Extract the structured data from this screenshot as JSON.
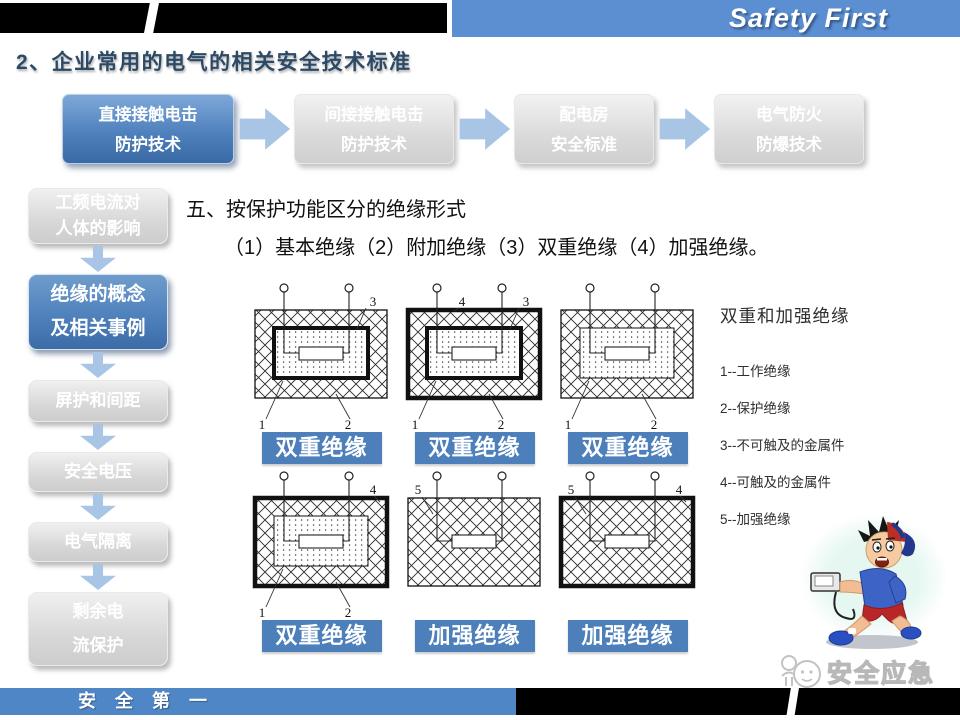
{
  "header": {
    "brand": "Safety First",
    "title": "2、企业常用的电气的相关安全技术标准"
  },
  "process_flow": [
    {
      "line1": "直接接触电击",
      "line2": "防护技术",
      "active": true
    },
    {
      "line1": "间接接触电击",
      "line2": "防护技术",
      "active": false
    },
    {
      "line1": "配电房",
      "line2": "安全标准",
      "active": false
    },
    {
      "line1": "电气防火",
      "line2": "防爆技术",
      "active": false
    }
  ],
  "sidebar": {
    "items": [
      {
        "line1": "工频电流对",
        "line2": "人体的影响",
        "active": false
      },
      {
        "line1": "绝缘的概念",
        "line2": "及相关事例",
        "active": true
      },
      {
        "line1": "屏护和间距",
        "active": false
      },
      {
        "line1": "安全电压",
        "active": false
      },
      {
        "line1": "电气隔离",
        "active": false
      },
      {
        "line1": "剩余电",
        "line2": "流保护",
        "active": false
      }
    ]
  },
  "content": {
    "heading": "五、按保护功能区分的绝缘形式",
    "subheading": "（1）基本绝缘（2）附加绝缘（3）双重绝缘（4）加强绝缘。",
    "diagrams": [
      {
        "caption": "双重绝缘",
        "outer": "thin",
        "inner": "thick",
        "labels": {
          "top_right": "3",
          "bottom_left": "1",
          "bottom_right": "2"
        }
      },
      {
        "caption": "双重绝缘",
        "outer": "thick",
        "inner": "thick",
        "labels": {
          "top_mid": "4",
          "top_right": "3",
          "bottom_left": "1",
          "bottom_right": "2"
        }
      },
      {
        "caption": "双重绝缘",
        "outer": "thin",
        "inner": "thin",
        "labels": {
          "bottom_left": "1",
          "bottom_right": "2"
        }
      },
      {
        "caption": "双重绝缘",
        "outer": "thick",
        "inner": "thin",
        "labels": {
          "top_right": "4",
          "bottom_left": "1",
          "bottom_right": "2"
        }
      },
      {
        "caption": "加强绝缘",
        "outer": "thin",
        "inner": null,
        "labels": {
          "top_left": "5"
        }
      },
      {
        "caption": "加强绝缘",
        "outer": "thick",
        "inner": null,
        "labels": {
          "top_left": "5",
          "top_right": "4"
        }
      }
    ],
    "legend": {
      "title": "双重和加强绝缘",
      "items": [
        "1--工作绝缘",
        "2--保护绝缘",
        "3--不可触及的金属件",
        "4--可触及的金属件",
        "5--加强绝缘"
      ]
    }
  },
  "footer": {
    "slogan": "安 全 第 一"
  },
  "watermark": {
    "text": "安全应急"
  },
  "icons": {
    "flow_arrow": "chevron-right",
    "sidebar_arrow": "chevron-down",
    "terminal": "circle-terminal"
  },
  "colors": {
    "header_blue": "#5b8fd1",
    "accent_blue": "#4f81bd",
    "caption_blue": "#4d7fbb",
    "arrow_blue": "#a9c5e5",
    "footer_blue": "#4f86c6",
    "title_blue": "#2c4a66"
  }
}
